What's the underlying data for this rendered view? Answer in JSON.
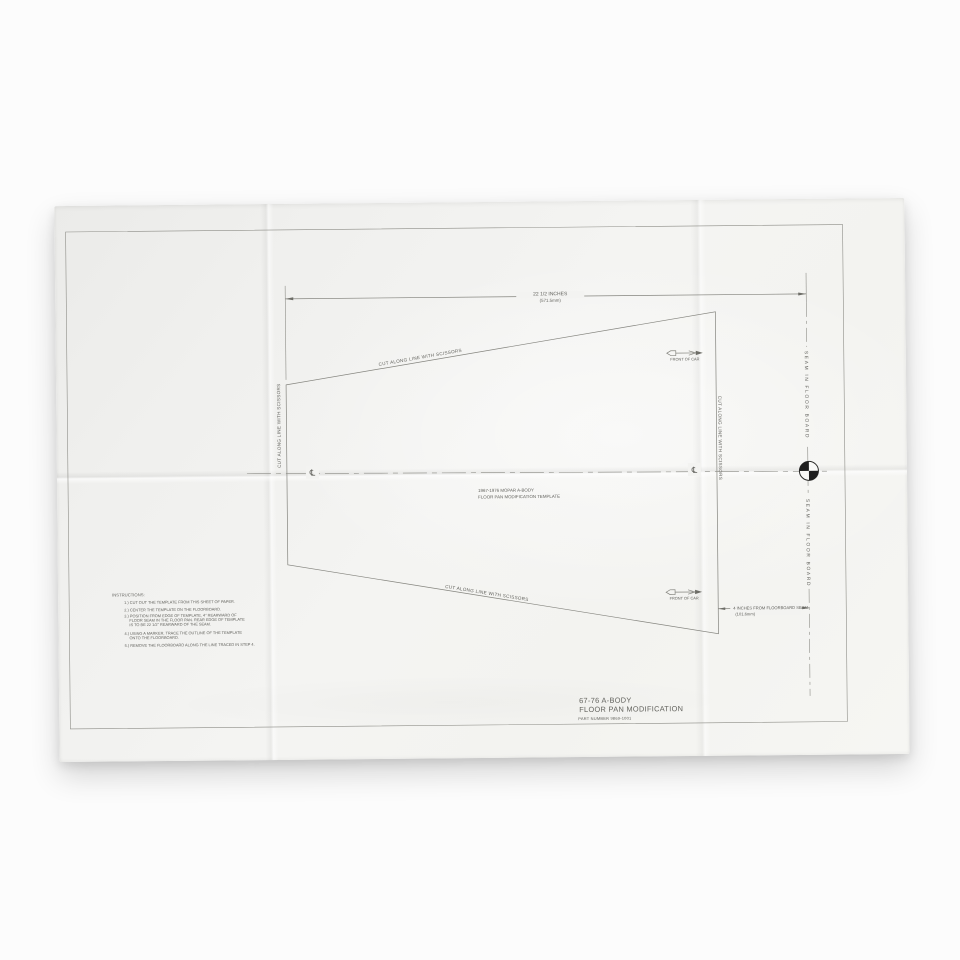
{
  "photo": {
    "subject": "folded paper cutting template photographed on white background",
    "colors": {
      "background": "#fcfcfc",
      "paper": "#f3f3f1",
      "line": "#84847e",
      "ink": "#63635e",
      "registration_mark": "#1e1e1e"
    }
  },
  "template": {
    "top_dimension": {
      "line1": "22 1/2 INCHES",
      "line2": "(571.5mm)"
    },
    "right_dimension": {
      "line1": "4 INCHES FROM FLOORBOARD SEAM",
      "line2": "(101.6mm)"
    },
    "cut_label": "CUT ALONG LINE WITH SCISSORS",
    "front_of_car_label": "FRONT OF CAR",
    "seam_label": "SEAM IN FLOOR BOARD",
    "centerline_symbol": "℄",
    "center_note": {
      "line1": "1967-1976 MOPAR A-BODY",
      "line2": "FLOOR PAN MODIFICATION TEMPLATE"
    },
    "instructions": {
      "heading": "INSTRUCTIONS:",
      "lines": [
        "1.) CUT OUT THE TEMPLATE FROM THIS SHEET OF PAPER.",
        "2.) CENTER THE TEMPLATE ON THE FLOORBOARD.",
        "3.) POSITION FROM EDGE OF TEMPLATE, 4\" REARWARD OF",
        "FLOOR SEAM IN THE FLOOR PAN.  REAR EDGE OF TEMPLATE",
        "IS TO BE 22 1/2\" REARWARD OF THE SEAM.",
        "4.) USING A MARKER, TRACE THE OUTLINE OF THE TEMPLATE",
        "ONTO THE FLOORBOARD.",
        "5.) REMOVE THE FLOORBOARD ALONG THE LINE TRACED IN STEP 4."
      ]
    },
    "title_block": {
      "line1": "67-76 A-BODY",
      "line2": "FLOOR PAN MODIFICATION",
      "part_number": "PART NUMBER 9869-1001"
    }
  }
}
